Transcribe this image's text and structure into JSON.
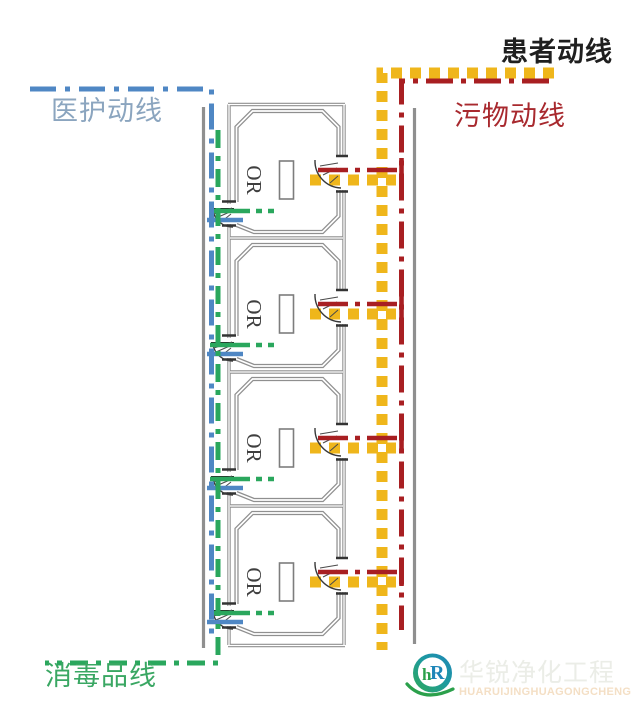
{
  "legend": {
    "patient": {
      "label": "患者动线",
      "text_color": "#1f1f1f",
      "line_color": "#efb61b",
      "line_style": "square-dotted"
    },
    "staff": {
      "label": "医护动线",
      "text_color": "#8ba5bf",
      "line_color": "#4f87c4",
      "line_style": "dash-dot"
    },
    "waste": {
      "label": "污物动线",
      "text_color": "#a8292e",
      "line_color": "#a81f22",
      "line_style": "dash-dot"
    },
    "disinfectant": {
      "label": "消毒品线",
      "text_color": "#3aa763",
      "line_color": "#2aa75d",
      "line_style": "dash-dot"
    }
  },
  "rooms": [
    {
      "label": "OR"
    },
    {
      "label": "OR"
    },
    {
      "label": "OR"
    },
    {
      "label": "OR"
    }
  ],
  "watermark": {
    "cn": "华锐净化工程",
    "en": "HUARUIJINGHUAGONGCHENG",
    "logo": {
      "h": "h",
      "r": "R"
    }
  },
  "colors": {
    "wall": "#8f8f8f",
    "door": "#333333",
    "background": "#ffffff",
    "logo_blue": "#1e86b8",
    "logo_green": "#2ba04b",
    "watermark_cn": "#ebede7",
    "watermark_en": "#f4dfc5"
  }
}
